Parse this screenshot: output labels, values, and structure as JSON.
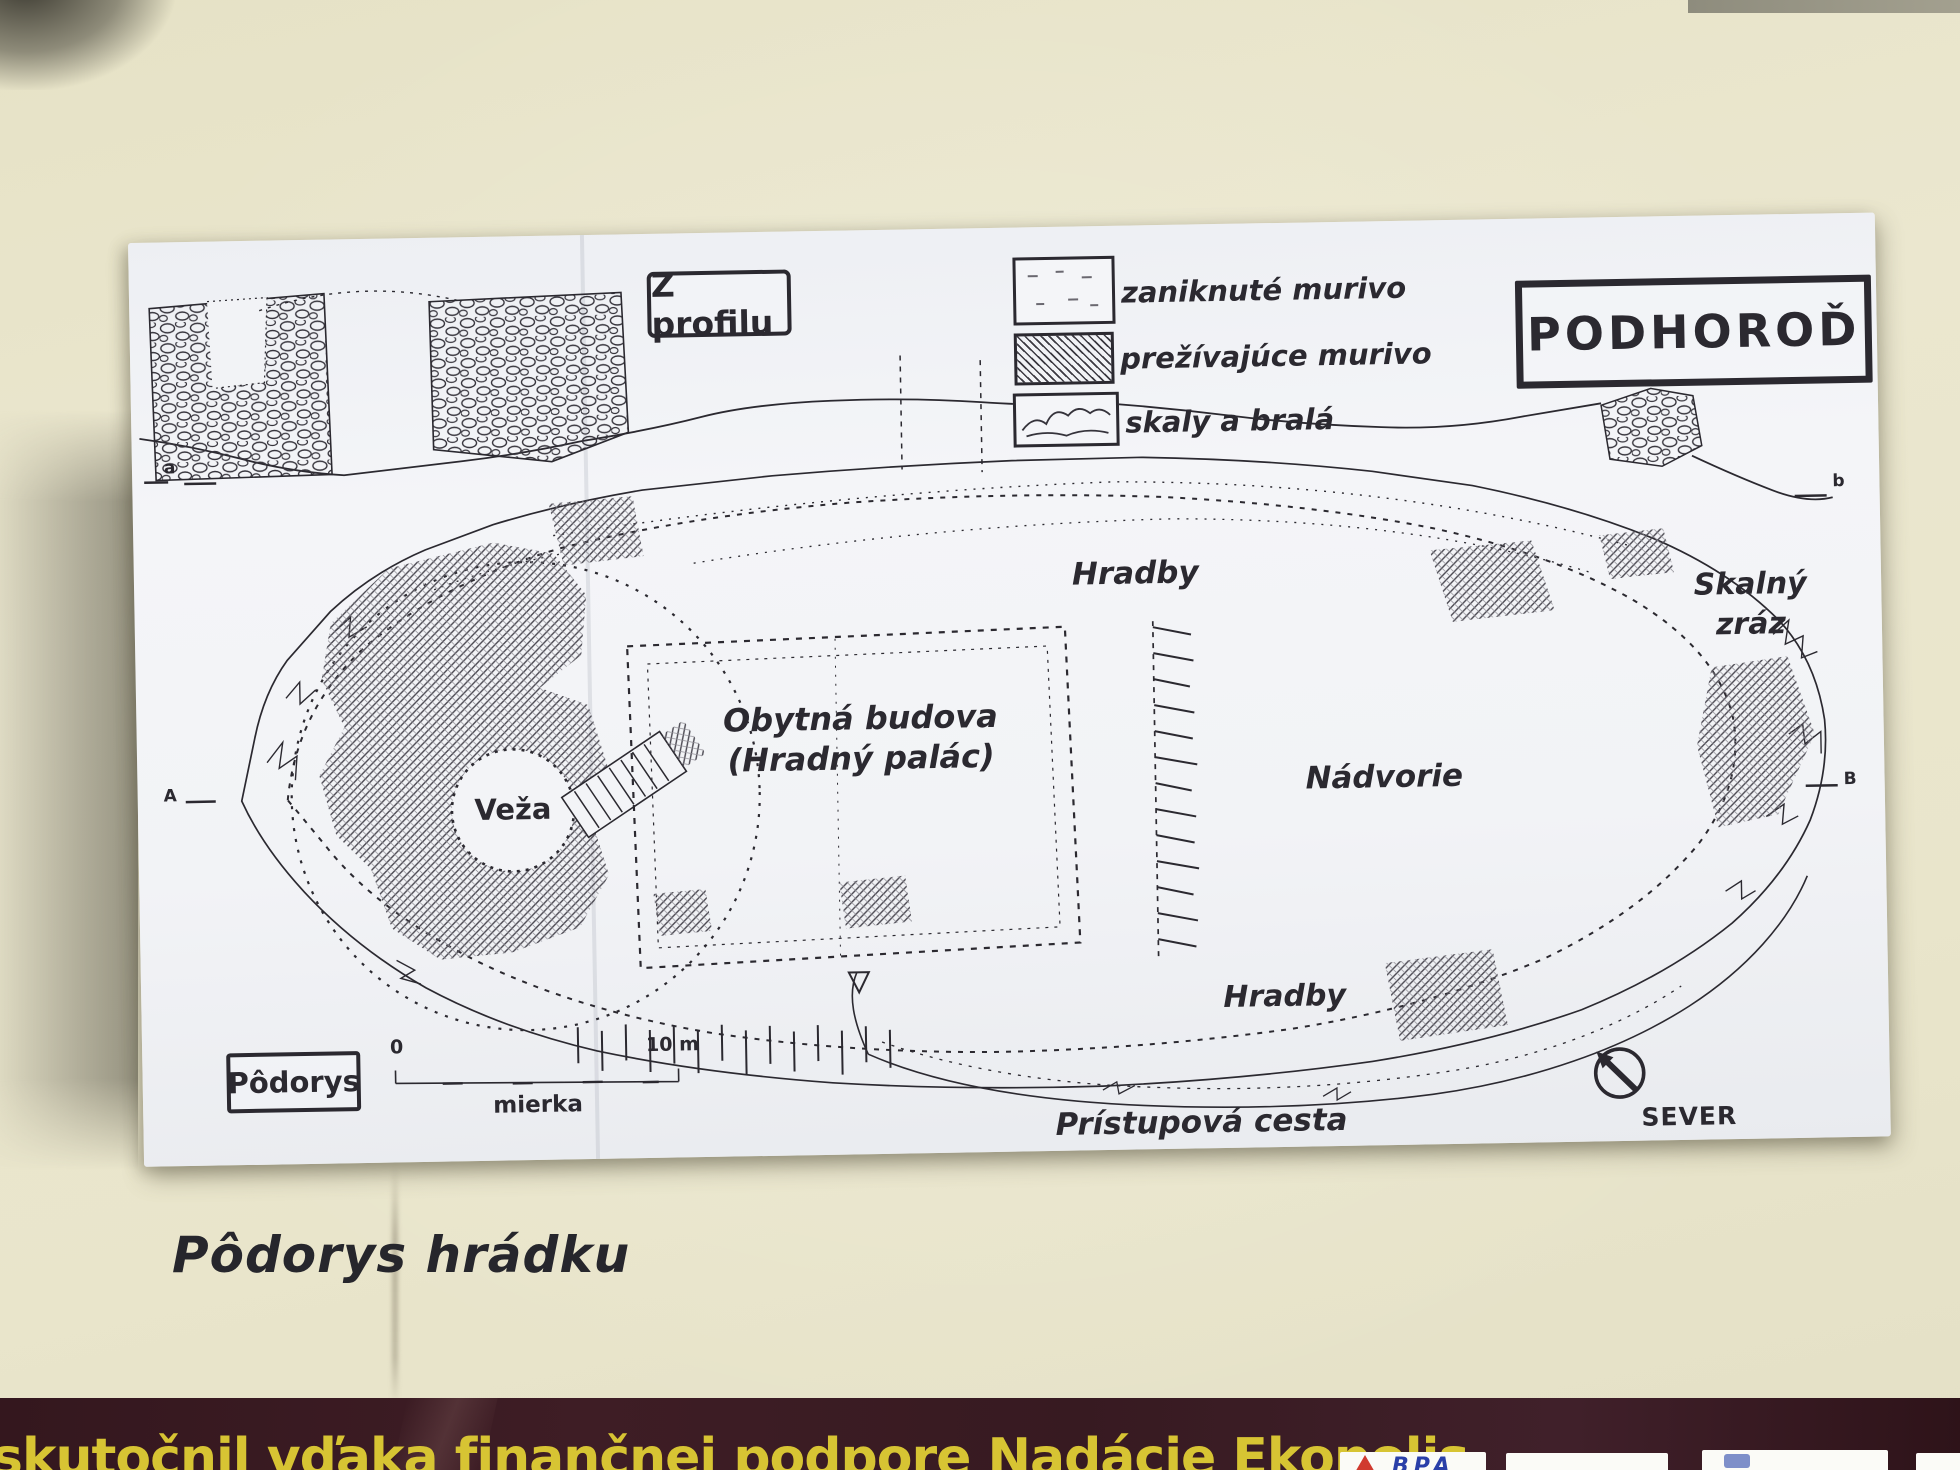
{
  "plan": {
    "title": "PODHOROĎ",
    "profile_view_label": "Z profilu",
    "plan_view_label": "Pôdorys",
    "legend": [
      {
        "id": "vanished-masonry",
        "label": "zaniknuté murivo"
      },
      {
        "id": "surviving-masonry",
        "label": "prežívajúce murivo"
      },
      {
        "id": "rocks-and-crags",
        "label": "skaly a bralá"
      }
    ],
    "labels": {
      "ramparts_top": "Hradby",
      "ramparts_bottom": "Hradby",
      "residential_line1": "Obytná budova",
      "residential_line2": "(Hradný palác)",
      "tower": "Veža",
      "courtyard": "Nádvorie",
      "cliff_line1": "Skalný",
      "cliff_line2": "zráz",
      "access_road": "Prístupová cesta",
      "north": "SEVER"
    },
    "scale": {
      "start": "0",
      "end": "10 m",
      "label": "mierka"
    },
    "section_markers": {
      "profile_left": "a",
      "profile_right": "b",
      "plan_left": "A",
      "plan_right": "B"
    }
  },
  "caption": "Pôdorys hrádku",
  "footer": {
    "text": "skutočnil vďaka finančnej podpore Nadácie Ekopolis",
    "logo_bpa": "BPA"
  },
  "colors": {
    "sign_background": "#e9e5cc",
    "paper": "#f2f3f6",
    "ink": "#2b2930",
    "footer_band": "#3a1b22",
    "footer_text": "#d7c433",
    "logo_blue": "#2a3fa8",
    "logo_red": "#d03a2e"
  }
}
